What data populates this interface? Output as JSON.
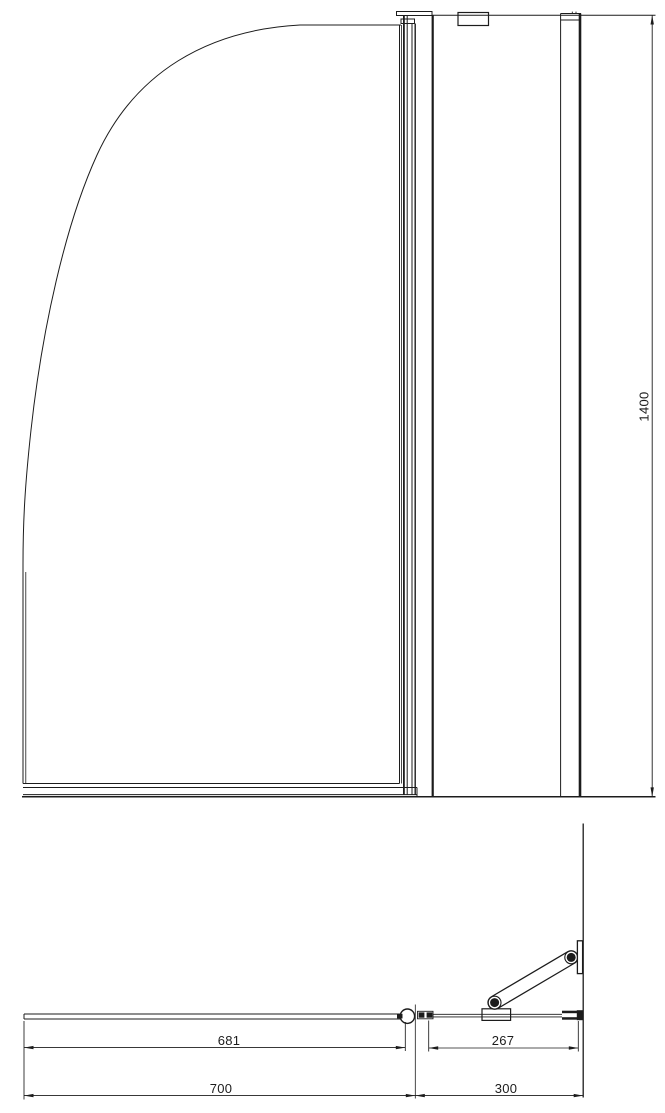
{
  "drawing": {
    "front_view": {
      "height_dim": "1400"
    },
    "plan_view": {
      "glass_width_dim": "681",
      "arm_span_dim": "267",
      "door_width_dim": "700",
      "return_width_dim": "300"
    }
  }
}
